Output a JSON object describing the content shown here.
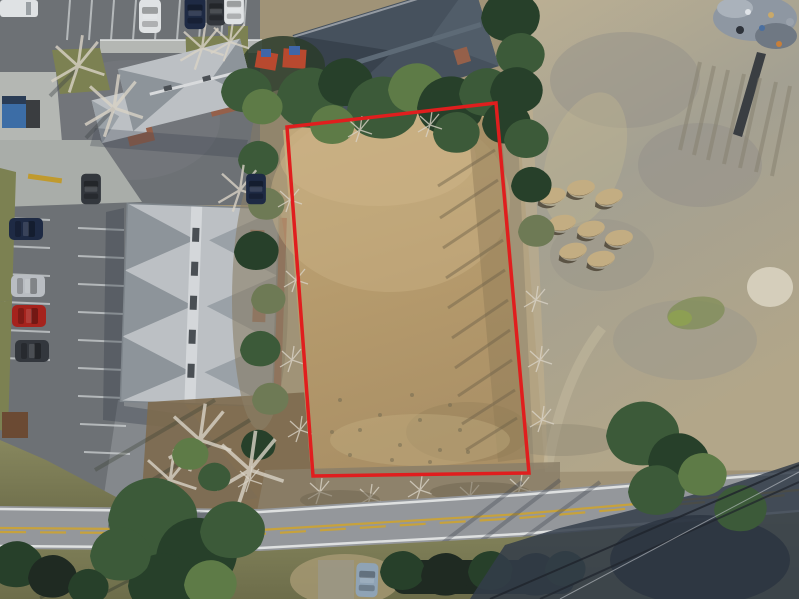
{
  "scene": {
    "type": "aerial-drone-photograph",
    "description": "Aerial drone photo of a vacant land parcel outlined with a red boundary, beside an apartment complex parking lot, a paved road with double yellow line below, and a large cleared dirt field to the right"
  },
  "boundary": {
    "label": "parcel-boundary",
    "points": "287,127 496,103 529,473 313,476",
    "color": "#e01e1e",
    "stroke_width": 3.5
  },
  "colors": {
    "red_boundary": "#e01e1e",
    "asphalt": "#6d7175",
    "asphalt_light": "#84888c",
    "road": "#94979b",
    "road_line": "#e6e8e8",
    "yellow_line": "#c7a23c",
    "dirt": "#b59a6c",
    "dirt_light": "#c9b286",
    "dirt_dark": "#8f7b57",
    "scrub": "#a09377",
    "leaf_litter": "#7d6a4e",
    "field_tan": "#b7aa8d",
    "field_gray": "#9b988a",
    "grass": "#7c8152",
    "tree_green": "#3c5a39",
    "tree_dark": "#27402a",
    "tree_light": "#5e7b47",
    "roof_light": "#bcc0c4",
    "roof_facet": "#8d949a",
    "roof_dark": "#46515d",
    "brick": "#95604a",
    "shadow": "#333b47",
    "white": "#dfe2e4",
    "car_red": "#a5231d",
    "car_navy": "#1e2a44",
    "car_silver": "#b9bdc2",
    "car_dark": "#33373d",
    "car_blue_gray": "#8fa3b5",
    "dumpster_blue": "#3c6da6",
    "playground_red": "#b8492f",
    "playground_blue": "#3f66a8"
  },
  "objects": [
    "red-outlined vacant parcel of cleared tan dirt",
    "apartment building with light gray hip roof",
    "small office building with gray roof",
    "rear building with dark blue-gray roof",
    "red playground equipment",
    "parking lot with striped spaces and parked cars",
    "two-lane road with double yellow center line",
    "driveway connecting parking lot to road",
    "large cleared sandy field with dirt mounds",
    "construction debris pile",
    "tree lines, hedges and long afternoon shadows",
    "parked car on gravel pull-off below road",
    "power line shadows across lower right"
  ]
}
